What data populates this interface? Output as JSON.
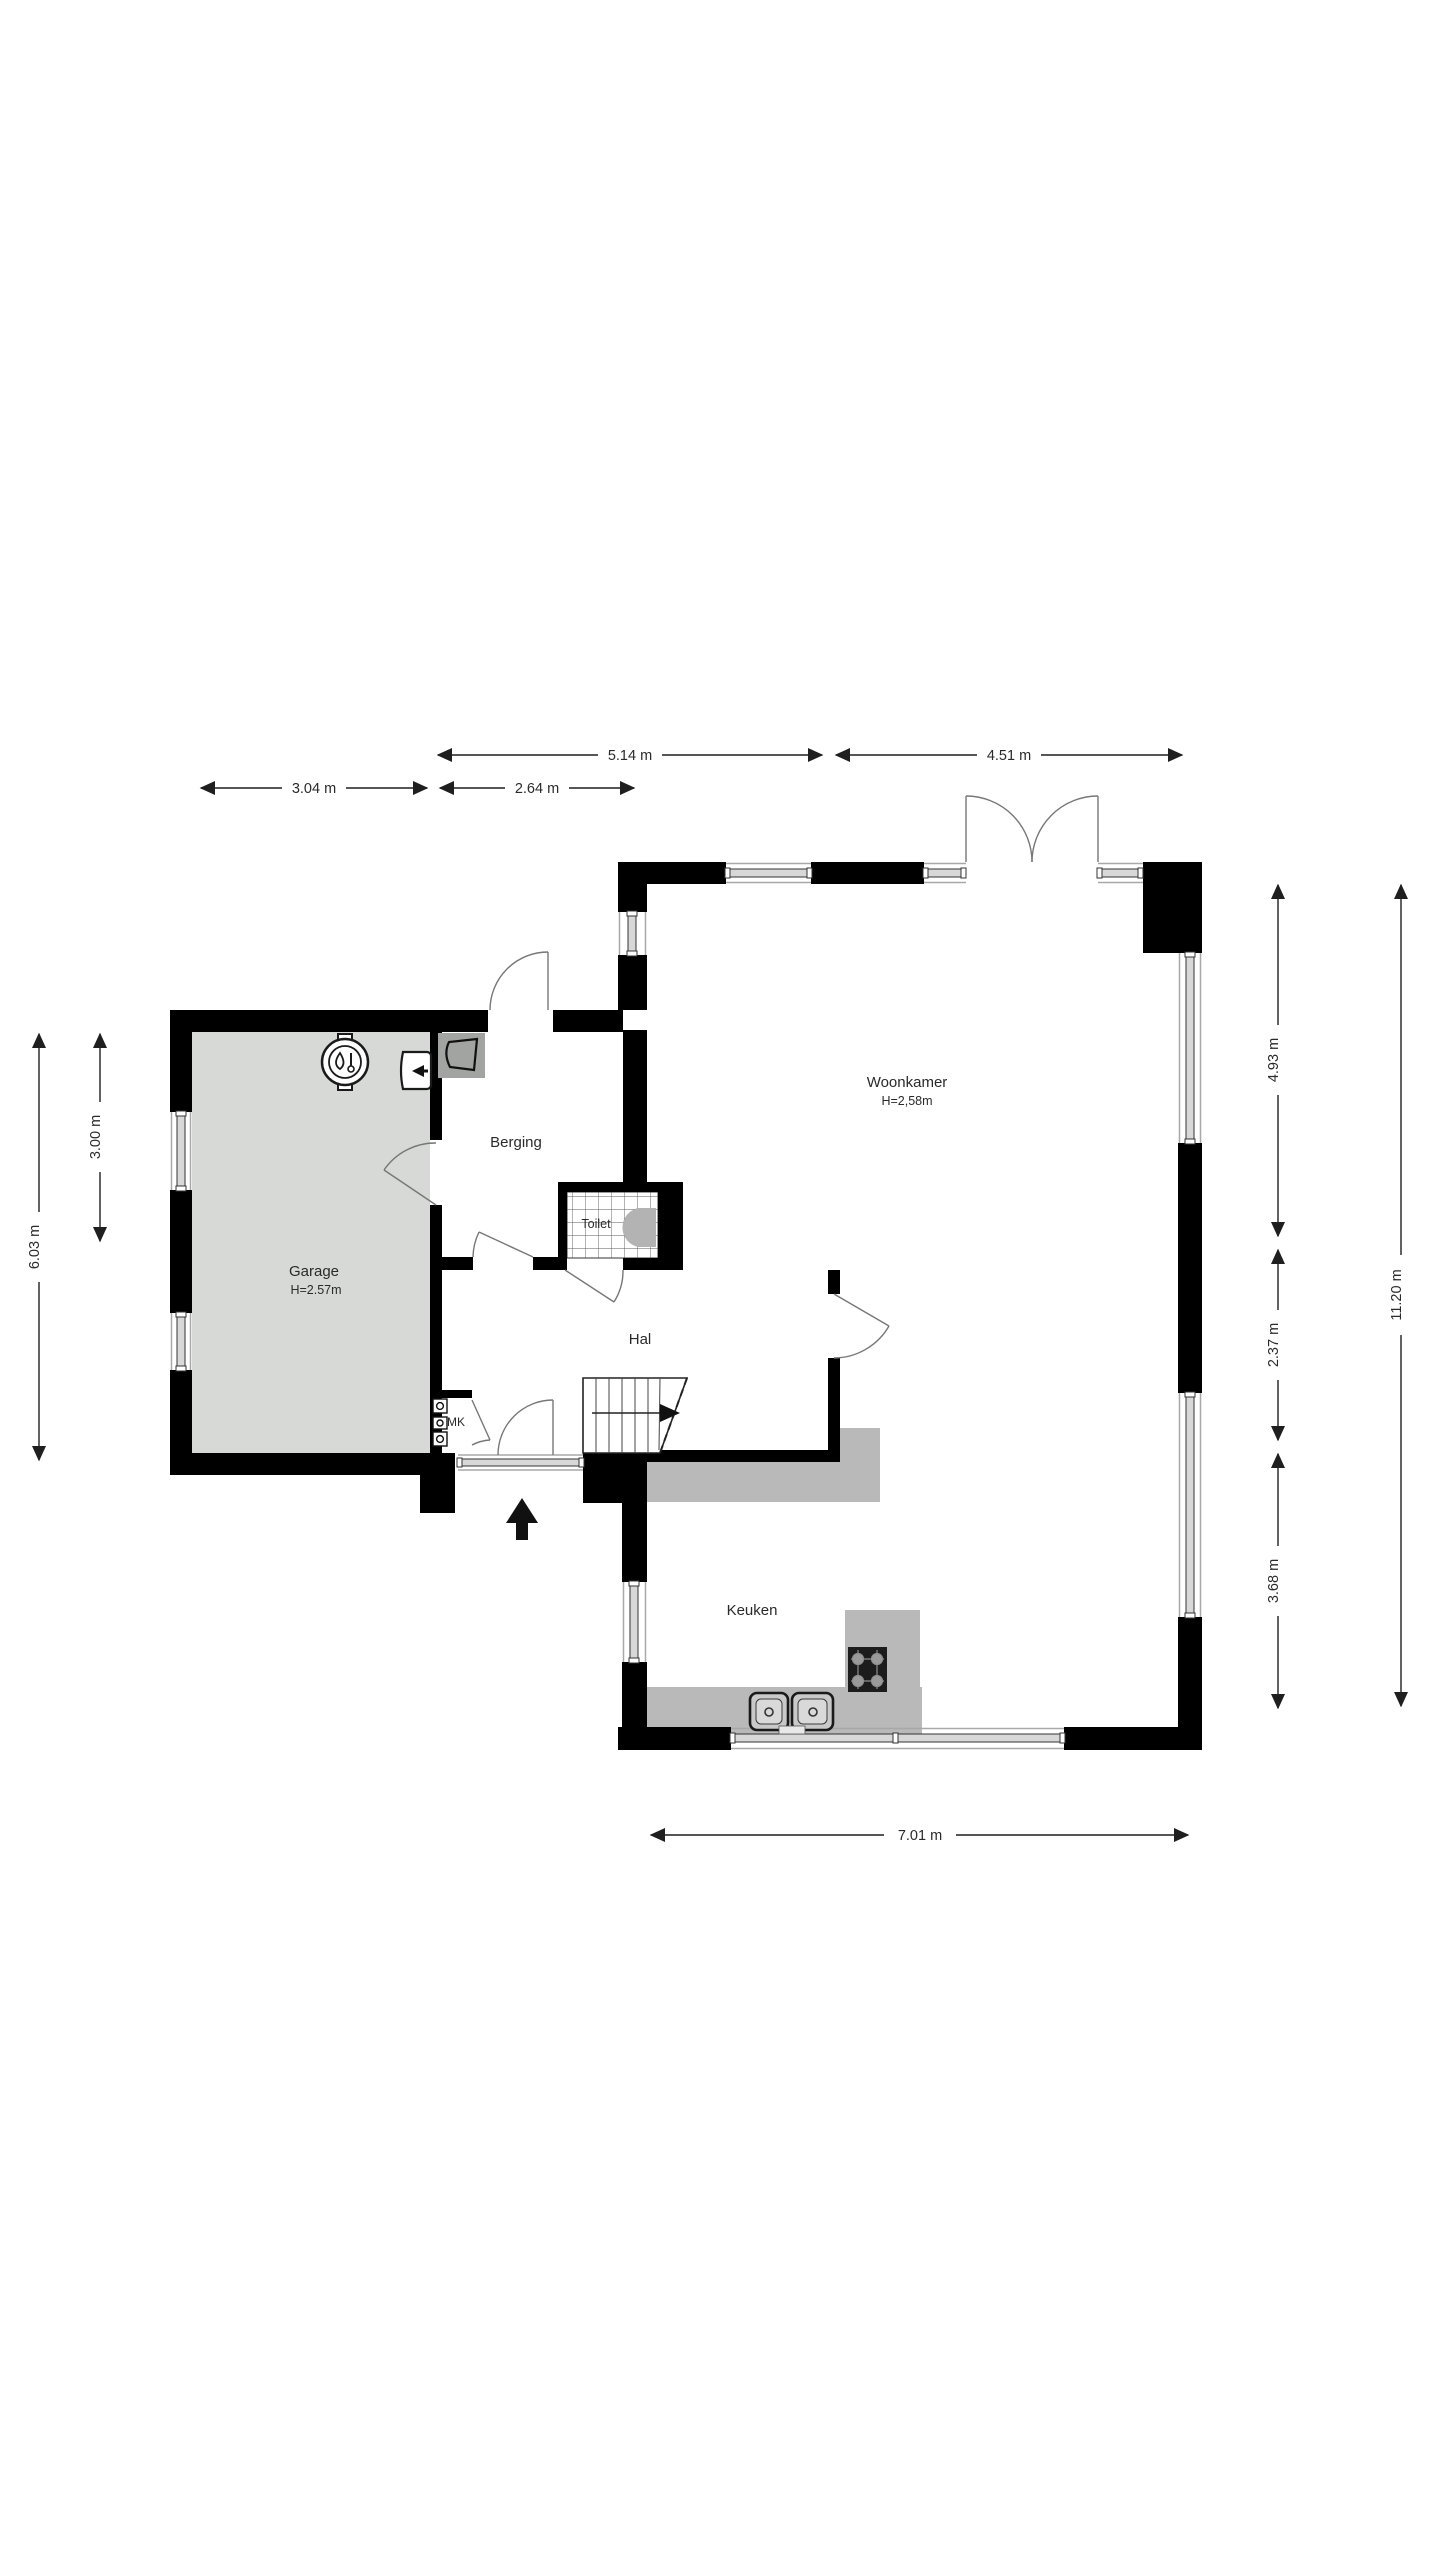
{
  "plan": {
    "type": "floorplan",
    "rooms": {
      "woonkamer": {
        "label": "Woonkamer",
        "height_label": "H=2,58m"
      },
      "berging": {
        "label": "Berging"
      },
      "toilet": {
        "label": "Toilet"
      },
      "garage": {
        "label": "Garage",
        "height_label": "H=2.57m"
      },
      "hal": {
        "label": "Hal"
      },
      "mk": {
        "label": "MK"
      },
      "keuken": {
        "label": "Keuken"
      }
    },
    "dimensions": {
      "top_514": "5.14 m",
      "top_451": "4.51 m",
      "top_304": "3.04 m",
      "top_264": "2.64 m",
      "left_603": "6.03 m",
      "left_300": "3.00 m",
      "right_493": "4.93 m",
      "right_237": "2.37 m",
      "right_368": "3.68 m",
      "right_1120": "11.20 m",
      "bottom_701": "7.01 m"
    },
    "icons": [
      "boiler-icon",
      "wall-unit-icon",
      "utility-box-icon",
      "toilet-icon",
      "stairs",
      "entrance-arrow-icon",
      "meter-cabinet-icon",
      "stove-icon",
      "kitchen-sink-icon"
    ],
    "colors": {
      "wall": "#000000",
      "garage_floor": "#d6d9d5",
      "surface_gray": "#b9b9b9",
      "window_band": "#d8d8d8",
      "dimension_text": "#2a2a2a"
    }
  }
}
